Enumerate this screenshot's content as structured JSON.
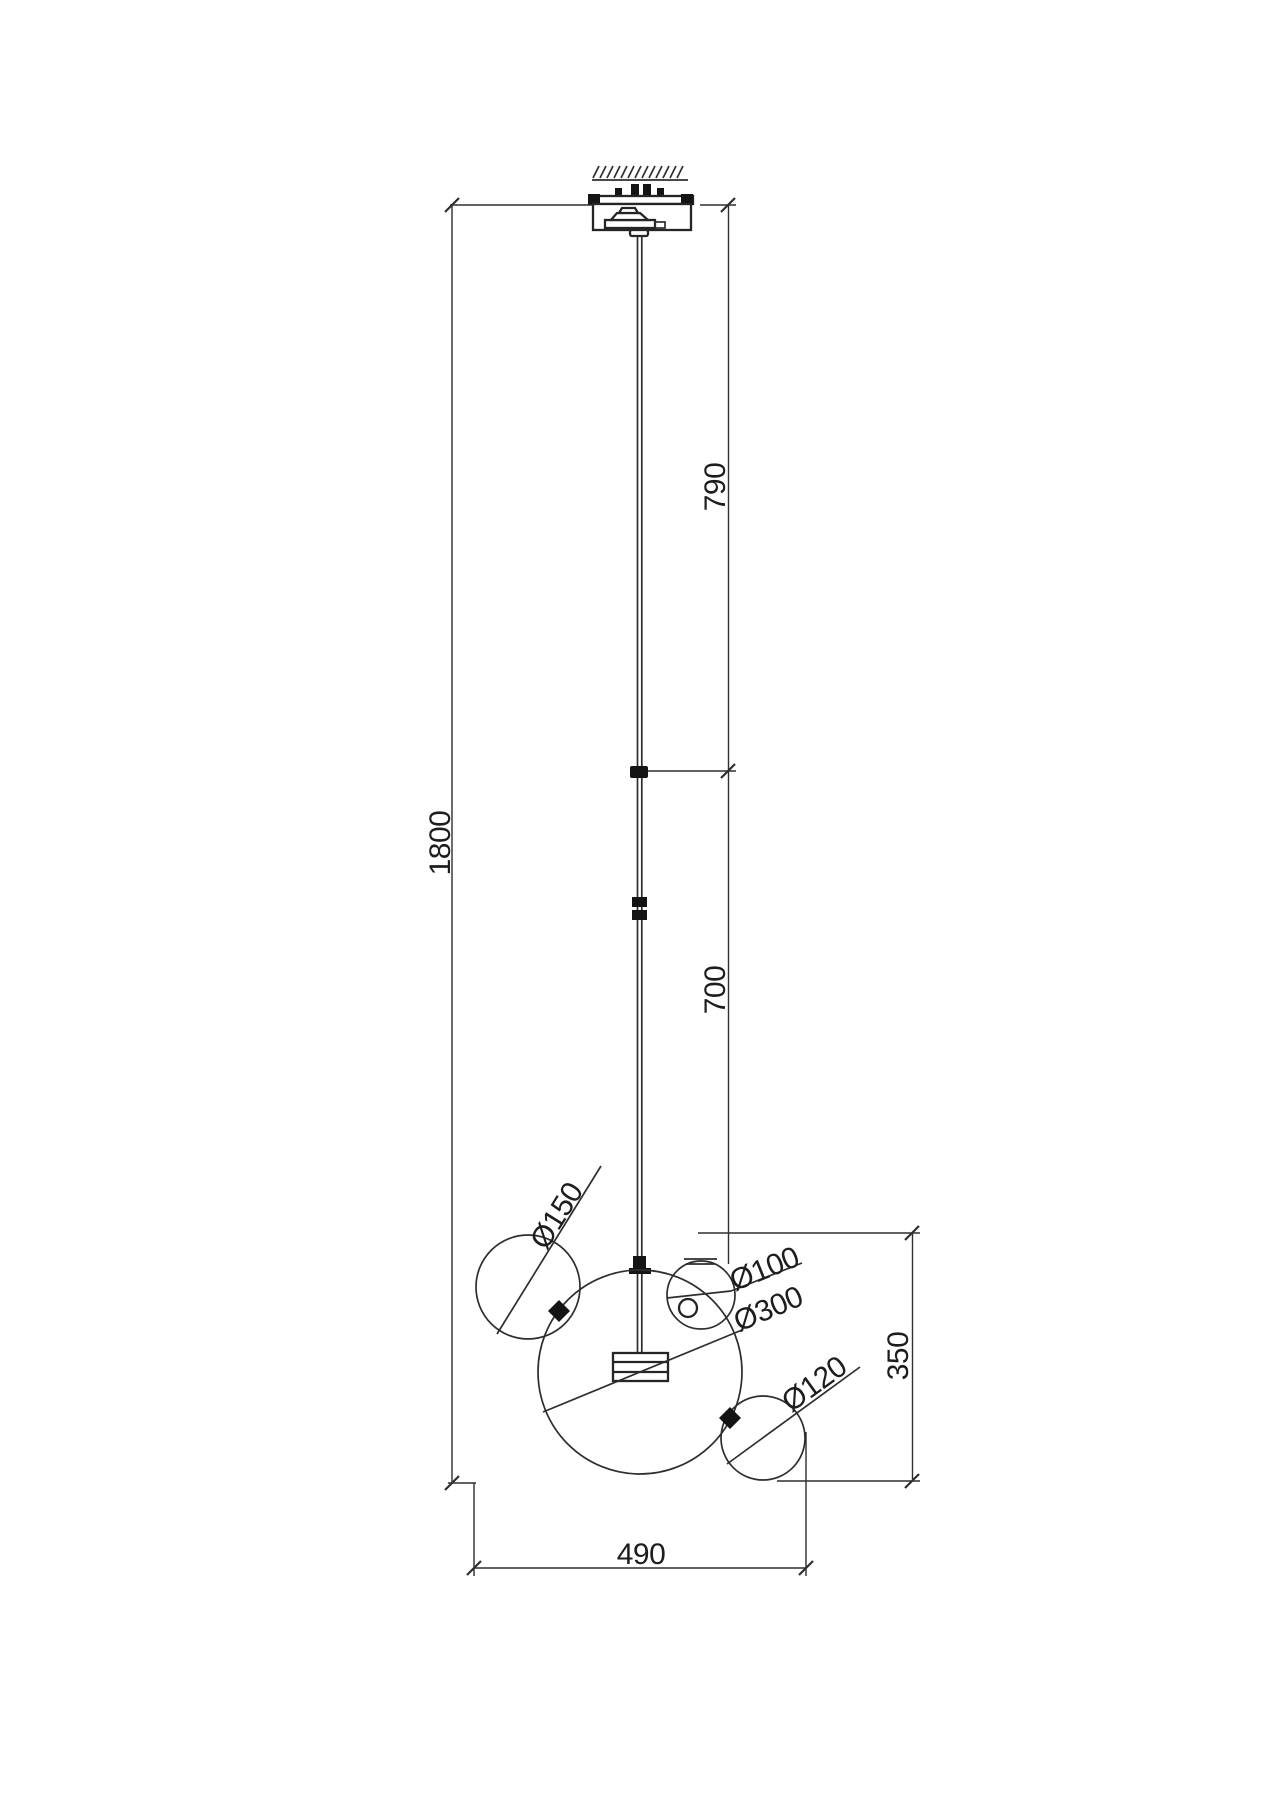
{
  "drawing": {
    "title": "Bubble glass pendant lamp - dimensional line drawing",
    "background": "#ffffff",
    "line_color": "#2e2e2e",
    "text_color": "#1d1d1d"
  },
  "dimensions": {
    "total_height": "1800",
    "upper_rod_length": "790",
    "lower_rod_length": "700",
    "shade_cluster_height": "350",
    "shade_cluster_width": "490"
  },
  "diameters": {
    "large_sphere": "Ø300",
    "medium_sphere": "Ø150",
    "small_top_sphere": "Ø100",
    "small_bottom_sphere": "Ø120"
  }
}
